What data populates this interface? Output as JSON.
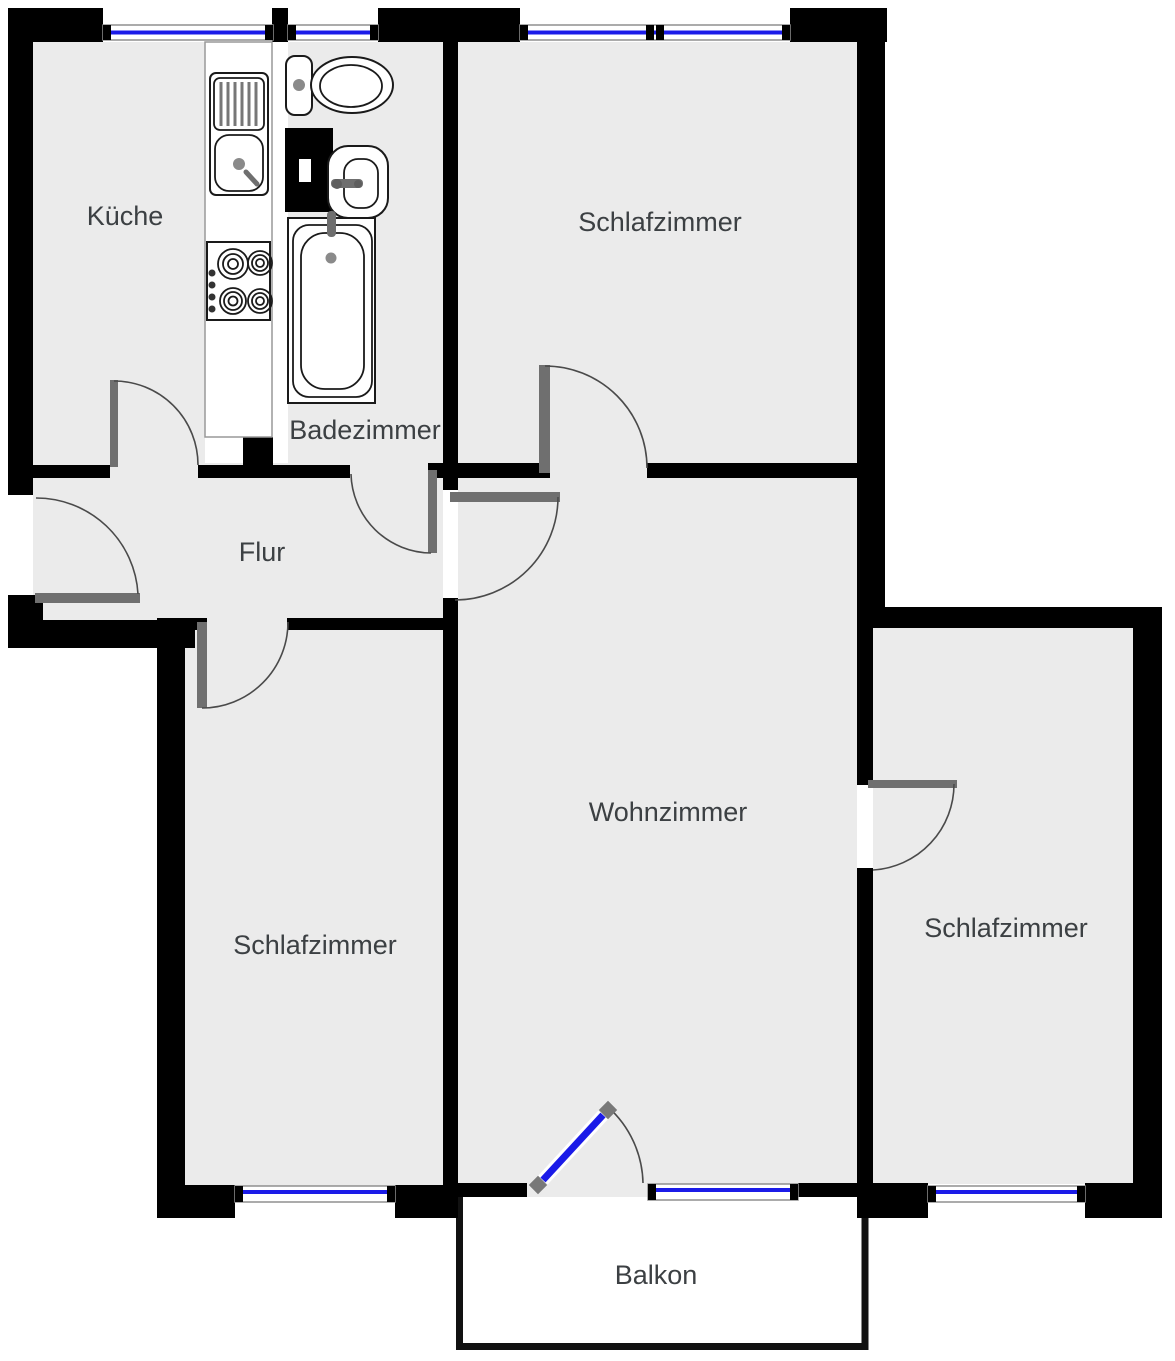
{
  "plan": {
    "type": "apartment-floor-plan",
    "rooms": [
      {
        "name": "Küche"
      },
      {
        "name": "Badezimmer"
      },
      {
        "name": "Schlafzimmer"
      },
      {
        "name": "Flur"
      },
      {
        "name": "Wohnzimmer"
      },
      {
        "name": "Schlafzimmer"
      },
      {
        "name": "Schlafzimmer"
      },
      {
        "name": "Balkon"
      }
    ],
    "colors": {
      "wall": "#000000",
      "room_fill": "#ebebeb",
      "window_glass": "#1b1be8",
      "door": "#6f6f6f",
      "label_text": "#3c4043",
      "outside": "#ffffff"
    },
    "fixtures": [
      "kitchen-counter",
      "kitchen-sink",
      "kitchen-stove",
      "toilet",
      "washbasin",
      "bathtub",
      "duct-shaft",
      "balcony-door",
      "entrance-door"
    ],
    "counts": {
      "windows": 6,
      "interior_doors": 7,
      "balcony_doors": 1
    }
  }
}
